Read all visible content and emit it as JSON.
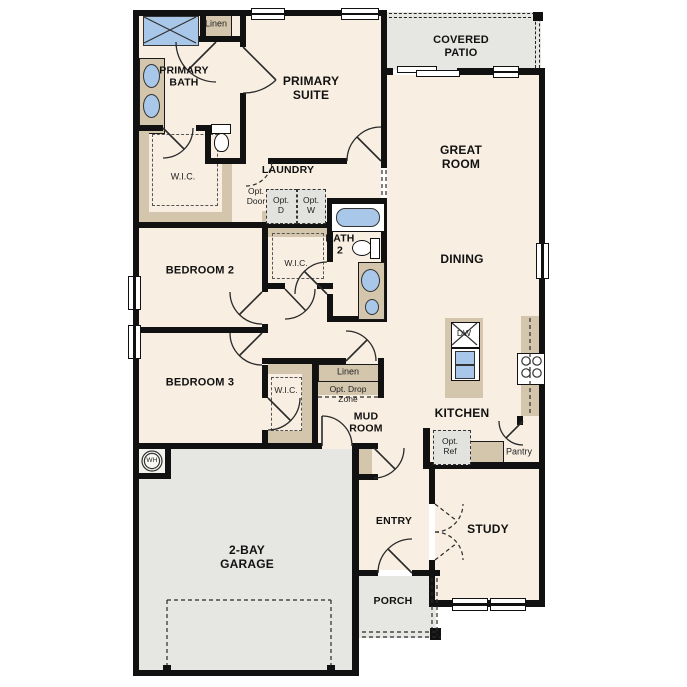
{
  "colors": {
    "floor": "#f8efe2",
    "concrete": "#e6e6e3",
    "cabinet": "#d3c6ac",
    "wall": "#111111",
    "fixture": "#a9c8e9"
  },
  "labels": {
    "covered_patio": "COVERED\nPATIO",
    "great_room": "GREAT\nROOM",
    "dining": "DINING",
    "kitchen": "KITCHEN",
    "primary_suite": "PRIMARY\nSUITE",
    "primary_bath": "PRIMARY\nBATH",
    "linen_bath": "Linen",
    "wic_primary": "W.I.C.",
    "laundry": "LAUNDRY",
    "opt_door": "Opt.\nDoor",
    "opt_dryer": "Opt.\nD",
    "opt_washer": "Opt.\nW",
    "bath2": "BATH\n2",
    "wic_bed2": "W.I.C.",
    "bedroom2": "BEDROOM 2",
    "bedroom3": "BEDROOM 3",
    "wic_bed3": "W.I.C.",
    "linen_hall": "Linen",
    "opt_drop_zone": "Opt. Drop\nZone",
    "mud_room": "MUD\nROOM",
    "dishwasher": "DW",
    "opt_ref": "Opt.\nRef",
    "pantry": "Pantry",
    "garage": "2-BAY\nGARAGE",
    "entry": "ENTRY",
    "porch": "PORCH",
    "study": "STUDY",
    "water_heater": "WH"
  }
}
